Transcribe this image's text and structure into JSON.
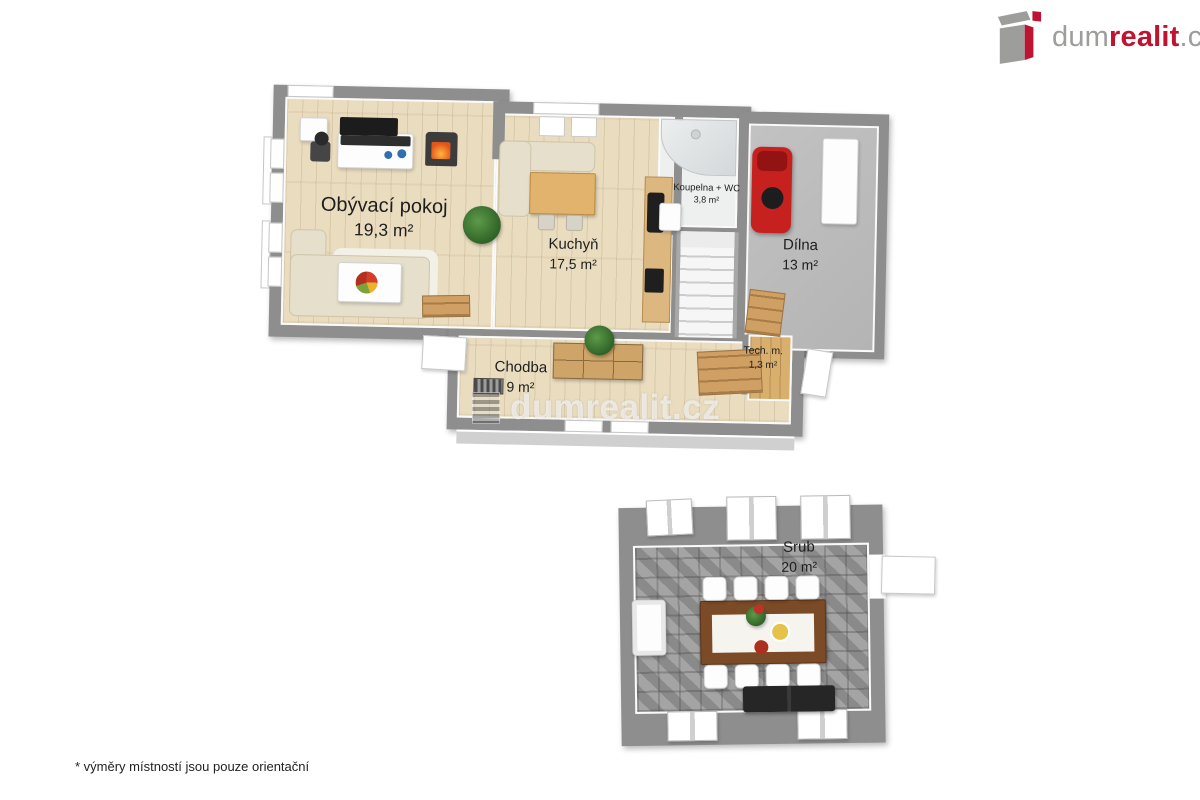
{
  "logo": {
    "dum": "dum",
    "realit": "realit",
    "cz": ".cz",
    "gray": "#9d9d9c",
    "red": "#bf1332"
  },
  "watermark": {
    "text": "dumrealit.cz"
  },
  "footnote": {
    "text": "* výměry místností jsou pouze orientační"
  },
  "rooms": {
    "obyvaci": {
      "label": "Obývací pokoj",
      "area": "19,3 m²"
    },
    "kuchyn": {
      "label": "Kuchyň",
      "area": "17,5 m²"
    },
    "koupelna": {
      "label": "Koupelna + WC",
      "area": "3,8 m²"
    },
    "dilna": {
      "label": "Dílna",
      "area": "13 m²"
    },
    "chodba": {
      "label": "Chodba",
      "area": "9 m²"
    },
    "techm": {
      "label": "Tech. m.",
      "area": "1,3 m²"
    },
    "srub": {
      "label": "Srub",
      "area": "20 m²"
    }
  },
  "colors": {
    "wall": "#8e8e8e",
    "wood_floor": "#e9dcbf",
    "concrete_floor": "#bcbcbc",
    "stone_floor": "#9a9a9a",
    "accent_red": "#bf1332",
    "logo_gray": "#9d9d9c"
  }
}
